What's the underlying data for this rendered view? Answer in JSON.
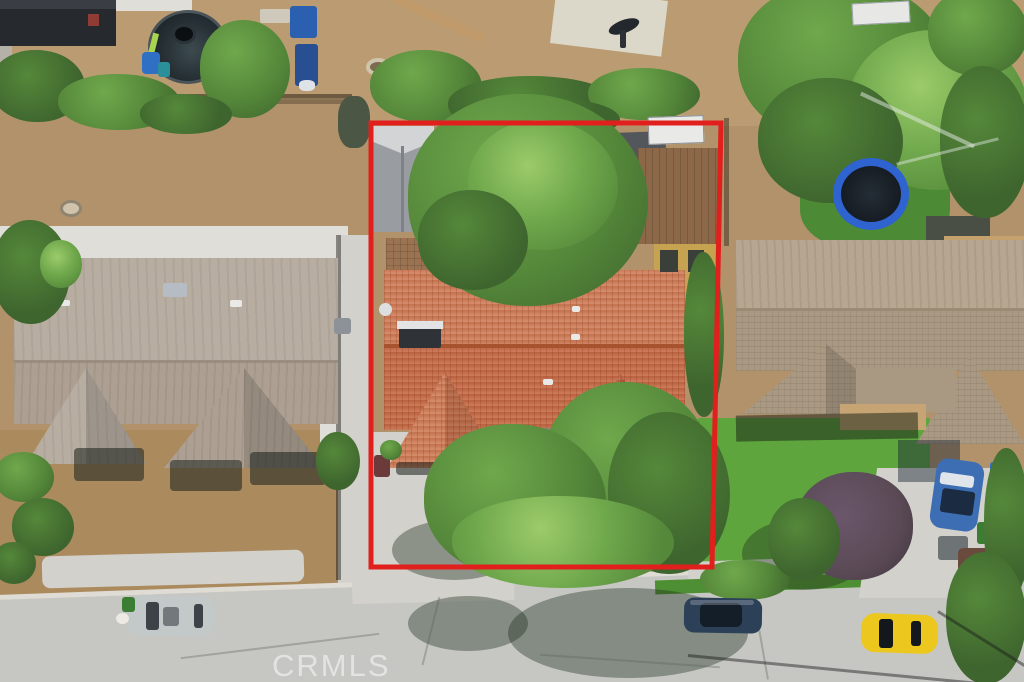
{
  "watermark": {
    "text": "CRMLS"
  },
  "scene": {
    "type": "aerial-real-estate-photo",
    "subject": "single-story house with red tile roof outlined by red property boundary",
    "objects": [
      "property-boundary-overlay",
      "subject-house-tile-roof",
      "left-neighbor-house",
      "right-neighbor-house",
      "street",
      "backyard-trampoline-dark",
      "backyard-trampoline-blue",
      "basketball-pad",
      "silver-car-street",
      "dark-blue-car-street",
      "yellow-car-street",
      "blue-car-driveway",
      "front-yard-trees",
      "backyard-tree",
      "right-lawn",
      "driveways",
      "sheds",
      "watermark"
    ]
  },
  "colors": {
    "dirt_base": "#b2926a",
    "dirt_light": "#bb9c72",
    "dirt_front": "#ab8a5e",
    "street": "#c6c7c3",
    "curb": "#dedcd4",
    "concrete": "#d2d1cc",
    "concrete_bright": "#dfded8",
    "roof_left_upper": "#b8ada1",
    "roof_left_lower": "#ada092",
    "roof_right_upper": "#b7a791",
    "roof_right_lower": "#aa9982",
    "roof_tile_upper": "#cf7b55",
    "roof_tile_lower": "#c66a45",
    "roof_tile_ridge": "#a8532f",
    "tree_dark": "#3e652e",
    "tree_mid": "#55883a",
    "tree_bright": "#6fa84c",
    "lawn": "#5ea53e",
    "boundary_red": "#e1201d",
    "shed_dark": "#26292e",
    "shed_brown": "#8c6849",
    "shed_yellow": "#c6a350",
    "shed_gray": "#999ca1",
    "trampoline_blue": "#2f63cf",
    "car_silver": "#c3c8c8",
    "car_dark_blue": "#2c4158",
    "car_yellow": "#ecc81e",
    "car_blue": "#3d6eb4",
    "bin_green": "#3a7d33",
    "bin_blue": "#2f6fc4",
    "purple_tree": "#5a4a55"
  }
}
